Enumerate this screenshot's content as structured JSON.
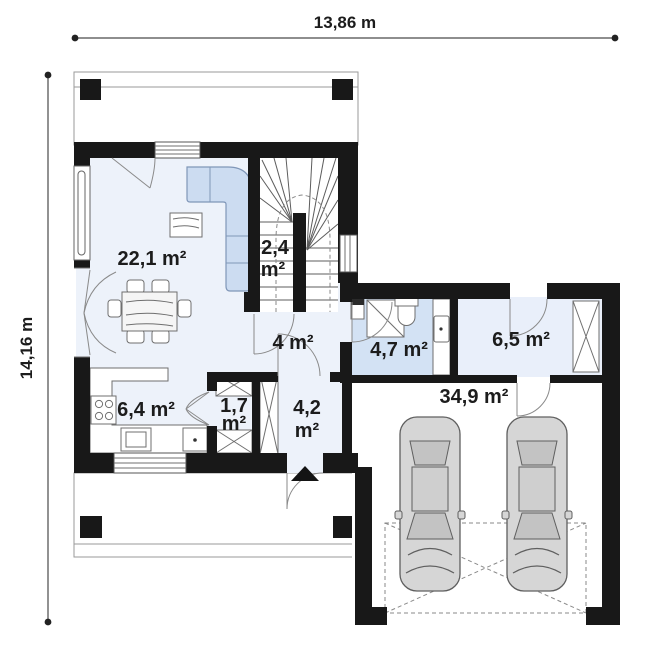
{
  "plan": {
    "title": "single-storey house floor plan",
    "dimensions": {
      "width_label": "13,86 m",
      "height_label": "14,16 m"
    },
    "rooms": {
      "living_room": {
        "area": "22,1 m²"
      },
      "staircase": {
        "area_value": "2,4",
        "area_unit": "m²"
      },
      "hall": {
        "area": "4 m²"
      },
      "bathroom": {
        "area": "4,7 m²"
      },
      "utility_room": {
        "area": "6,5 m²"
      },
      "kitchen": {
        "area": "6,4 m²"
      },
      "closet": {
        "area_value": "1,7",
        "area_unit": "m²"
      },
      "vestibule": {
        "area_value": "4,2",
        "area_unit": "m²"
      },
      "garage": {
        "area": "34,9 m²"
      }
    },
    "colors": {
      "wall": "#181818",
      "floor_main": "#edf2fa",
      "floor_bathroom": "#d3e2f4",
      "floor_utility": "#e9effa",
      "furniture_accent": "#ccdcf1",
      "car_body": "#d6d6d6"
    }
  }
}
